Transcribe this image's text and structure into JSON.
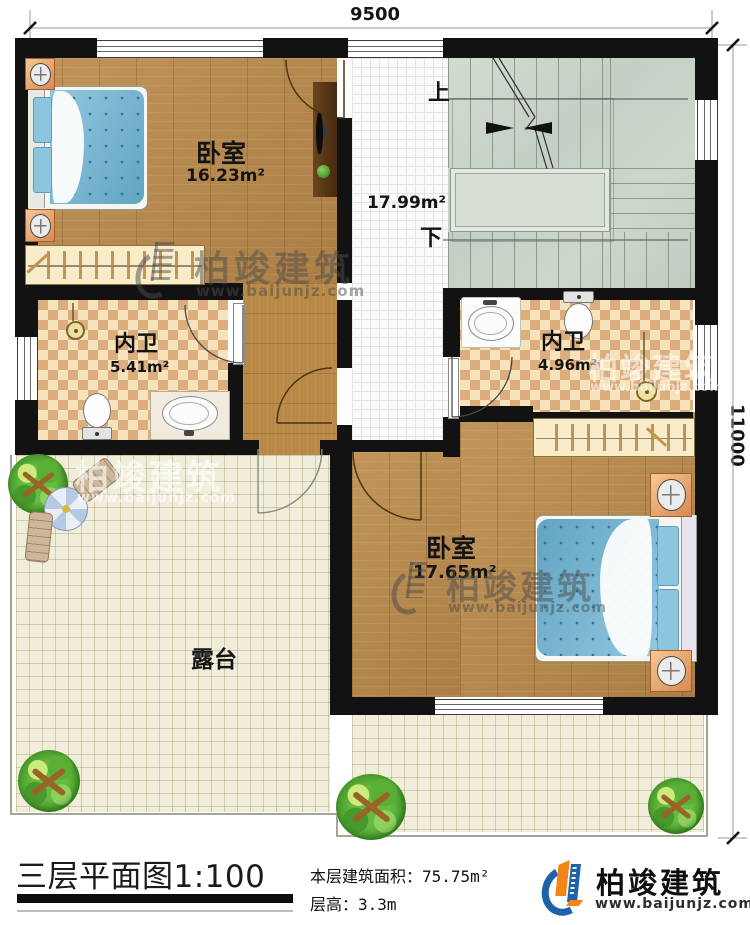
{
  "dimensions": {
    "top": "9500",
    "right": "11000"
  },
  "stairs": {
    "up": "上",
    "down": "下"
  },
  "rooms": {
    "bedroom1": {
      "name": "卧室",
      "area": "16.23m²"
    },
    "hall": {
      "area": "17.99m²"
    },
    "bath1": {
      "name": "内卫",
      "area": "5.41m²"
    },
    "bath2": {
      "name": "内卫",
      "area": "4.96m²"
    },
    "bedroom2": {
      "name": "卧室",
      "area": "17.65m²"
    },
    "terrace": {
      "name": "露台"
    }
  },
  "title_block": {
    "title": "三层平面图1:100",
    "area_label": "本层建筑面积：",
    "area_value": "75.75m²",
    "floor_height_label": "层高：",
    "floor_height_value": "3.3m"
  },
  "brand": {
    "name": "柏竣建筑",
    "website": "www.baijunjz.com"
  },
  "watermark": {
    "name": "柏竣建筑",
    "website": "www.baijunjz.com"
  },
  "colors": {
    "wall": "#121212",
    "wood": "#bd8c4c",
    "bed_blue": "#6fb5d3",
    "brand_blue": "#1e62ab",
    "brand_orange": "#f08519"
  }
}
